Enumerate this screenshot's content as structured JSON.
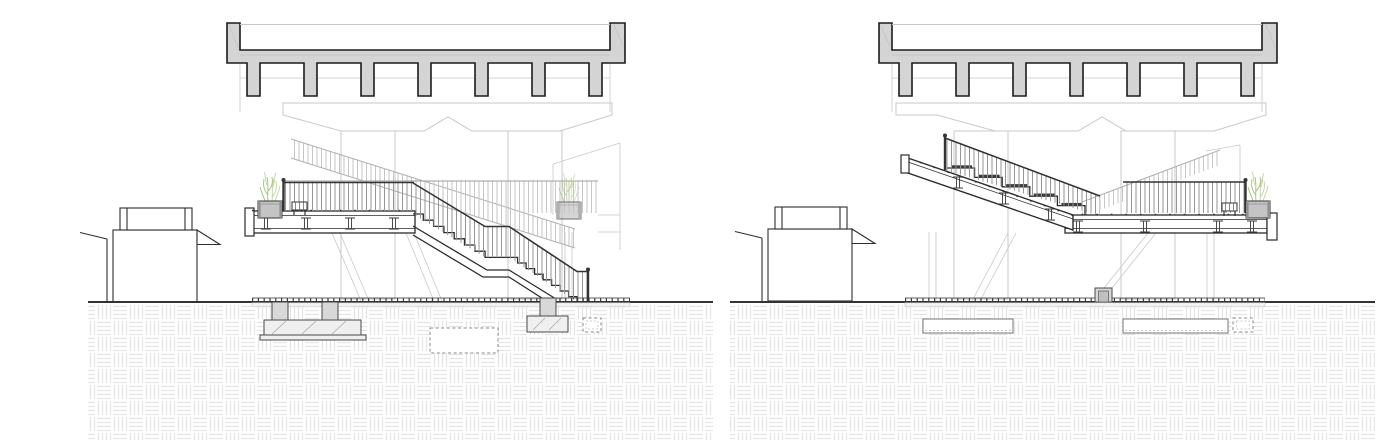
{
  "meta": {
    "drawing_type": "architectural elevation sections, two panels side by side",
    "text_content": "none (drawing contains no text)"
  },
  "panels": [
    {
      "name": "left-elevation",
      "features": [
        "bridge-deck-section",
        "pier-caps",
        "platform",
        "planter",
        "bench",
        "stair-with-landing",
        "kiosk",
        "ground-hatch",
        "foundations"
      ]
    },
    {
      "name": "right-elevation",
      "features": [
        "bridge-deck-section",
        "pier-caps",
        "platform",
        "planter",
        "bench",
        "stepped-ramp",
        "kiosk",
        "ground-hatch",
        "foundations"
      ]
    }
  ],
  "colors": {
    "background": "#ffffff",
    "deck-fill": "#d4d4d4",
    "deck-stroke": "#1c1c1c",
    "line-dark": "#2b2b2b",
    "line-bg": "#c9c9c9",
    "rail-dark": "#333333",
    "baluster-fg": "#969696",
    "baluster-bg": "#c6c6c6",
    "planter-fill": "#c4c4c4",
    "plant-green": "#9dbf78",
    "plant-green-2": "#bdd69c",
    "hatch-line": "#e3e3e3",
    "fill-light": "#efefef",
    "concrete-mid": "#d8d8d8"
  }
}
